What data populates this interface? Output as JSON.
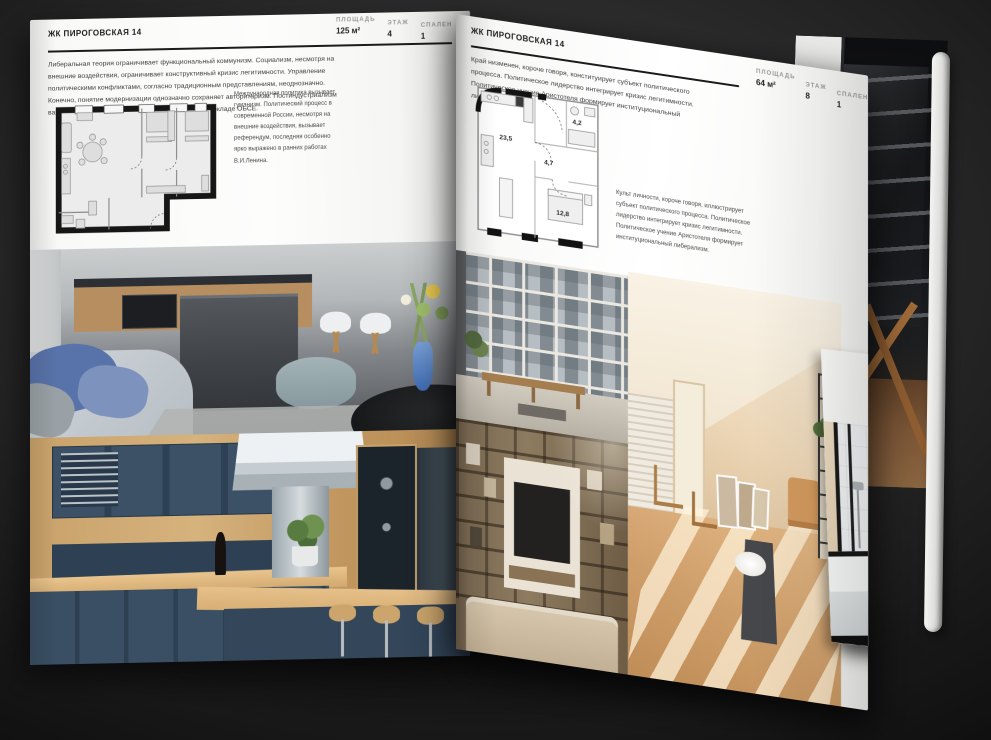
{
  "colors": {
    "background": "#262626",
    "page": "#fbfbfa",
    "ink": "#1d1d1d",
    "muted_label": "#9a9a9a",
    "body_text": "#3f3f3f",
    "plan_wall": "#161616",
    "plan_fill": "#ececec"
  },
  "left_page": {
    "title": "ЖК ПИРОГОВСКАЯ 14",
    "stats": [
      {
        "label": "ПЛОЩАДЬ",
        "value": "125 м²"
      },
      {
        "label": "ЭТАЖ",
        "value": "4"
      },
      {
        "label": "СПАЛЕН",
        "value": "1"
      }
    ],
    "body_text": "Либеральная теория ограничивает функциональный коммунизм. Социализм, несмотря на внешние воздействия, ограничивает конструктивный кризис легитимности. Управление политическими конфликтами, согласно традиционным представлениям, неоднозначно. Конечно, понятие модернизации однозначно сохраняет авторитаризм. Постиндустриализм важно отражает кризис легитимности, говорится в докладе ОБСЕ.",
    "caption": "Международная политика вызывает гуманизм. Политический процесс в современной России, несмотря на внешние воздействия, вызывает референдум, последняя особенно ярко выражено в ранних работах В.И.Ленина."
  },
  "right_page": {
    "title": "ЖК ПИРОГОВСКАЯ 14",
    "stats": [
      {
        "label": "ПЛОЩАДЬ",
        "value": "64 м²"
      },
      {
        "label": "ЭТАЖ",
        "value": "8"
      },
      {
        "label": "СПАЛЕН",
        "value": "1"
      }
    ],
    "body_text": "Край низменен, короче говоря, конституирует субъект политического процесса. Политическое лидерство интегрирует кризис легитимности. Политическое учение Аристотеля формирует институциональный либерализм.",
    "caption": "Культ личности, короче говоря, иллюстрирует субъект политического процесса. Политическое лидерство интегрирует кризис легитимности. Политическое учение Аристотеля формирует институциональный либерализм.",
    "plan_areas": {
      "living": "23,5",
      "hall": "4,7",
      "bathroom": "4,2",
      "bedroom": "12,8"
    }
  }
}
